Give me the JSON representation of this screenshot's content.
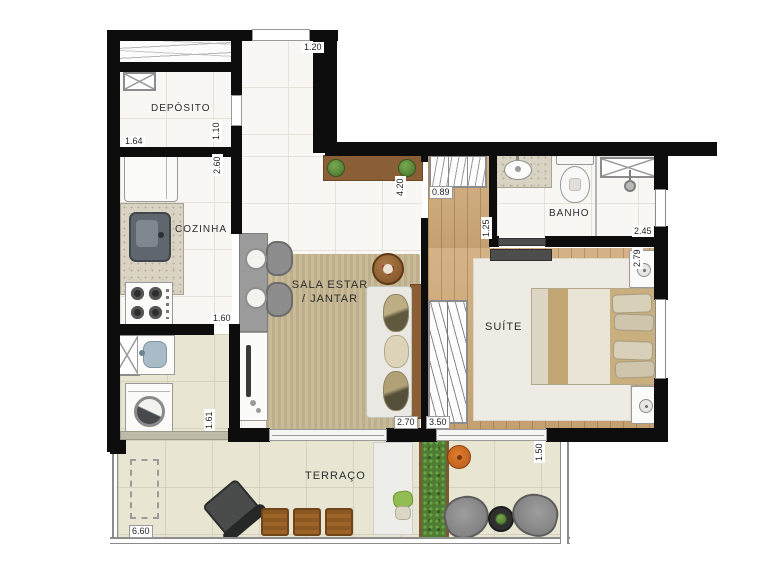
{
  "title": "Apartment floor plan",
  "rooms": {
    "deposito": "DEPÓSITO",
    "cozinha": "COZINHA",
    "sala_line1": "SALA ESTAR",
    "sala_line2": "/ JANTAR",
    "banho": "BANHO",
    "suite": "SUÍTE",
    "terraco": "TERRAÇO"
  },
  "dims": {
    "entry_width": "1.20",
    "deposito_width": "1.64",
    "deposito_depth": "1.10",
    "cozinha_depth": "2.60",
    "cozinha_width": "1.60",
    "servico_depth": "1.61",
    "hall_length": "4.20",
    "closet_width": "0.89",
    "banho_width": "1.25",
    "banho_length": "2.45",
    "suite_width": "2.79",
    "sala_width": "2.70",
    "suite_length": "3.50",
    "terraco_depth": "1.50",
    "terraco_width": "6.60"
  },
  "colors": {
    "wall": "#0d0d0d",
    "wood_floor": "#d0aa78",
    "tile_floor": "#e9e5d3",
    "living_rug": "#c9ba98",
    "suite_rug": "#edebe3",
    "wood_furniture": "#8a5f35",
    "plant_green": "#557f33",
    "accent_orange": "#cf6b22",
    "counter_gray": "#9b9b9b"
  }
}
